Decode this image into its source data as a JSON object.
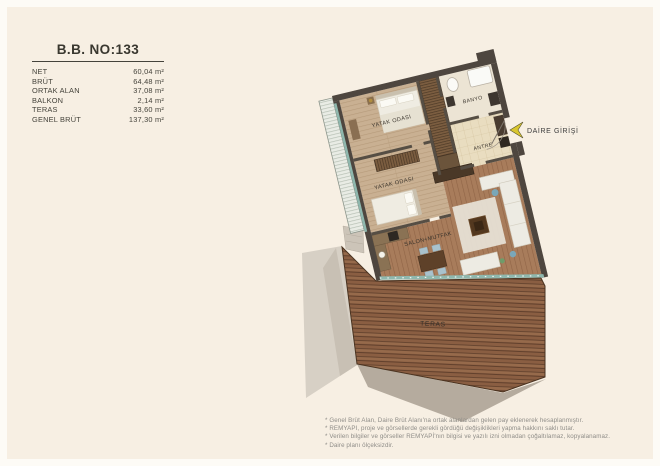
{
  "header": {
    "unit_title": "B.B. NO:133"
  },
  "specs": [
    {
      "label": "NET",
      "value": "60,04 m²"
    },
    {
      "label": "BRÜT",
      "value": "64,48 m²"
    },
    {
      "label": "ORTAK ALAN",
      "value": "37,08 m²"
    },
    {
      "label": "BALKON",
      "value": "2,14 m²"
    },
    {
      "label": "TERAS",
      "value": "33,60 m²"
    },
    {
      "label": "GENEL BRÜT",
      "value": "137,30 m²"
    }
  ],
  "plan": {
    "rooms": {
      "bedroom1": "YATAK ODASI",
      "bedroom2": "YATAK ODASI",
      "bathroom": "BANYO",
      "hall": "ANTRE",
      "living": "SALON+MUTFAK",
      "terrace": "TERAS"
    },
    "entrance_label": "DAİRE GİRİŞİ",
    "icons": {
      "entrance_arrow": "left-arrow"
    },
    "colors": {
      "background": "#f7efe3",
      "wall": "#4e463f",
      "wood_bedroom": "#c9b092",
      "wood_salon": "#a87c5b",
      "deck": "#8a5e42",
      "deck_line": "#5d3d2a",
      "tile": "#e9ddc0",
      "glass": "#8fb8ae",
      "arrow_yellow": "#d9c62f",
      "shadow_gray": "#b5ab9e"
    }
  },
  "footnotes": [
    "* Genel Brüt Alan, Daire Brüt Alanı'na ortak alanlardan gelen pay eklenerek hesaplanmıştır.",
    "* REMYAPI, proje ve görsellerde gerekli gördüğü değişiklikleri yapma hakkını saklı tutar.",
    "* Verilen bilgiler ve görseller REMYAPİ'nın bilgisi ve yazılı izni olmadan çoğaltılamaz, kopyalanamaz.",
    "* Daire planı ölçeksizdir."
  ]
}
